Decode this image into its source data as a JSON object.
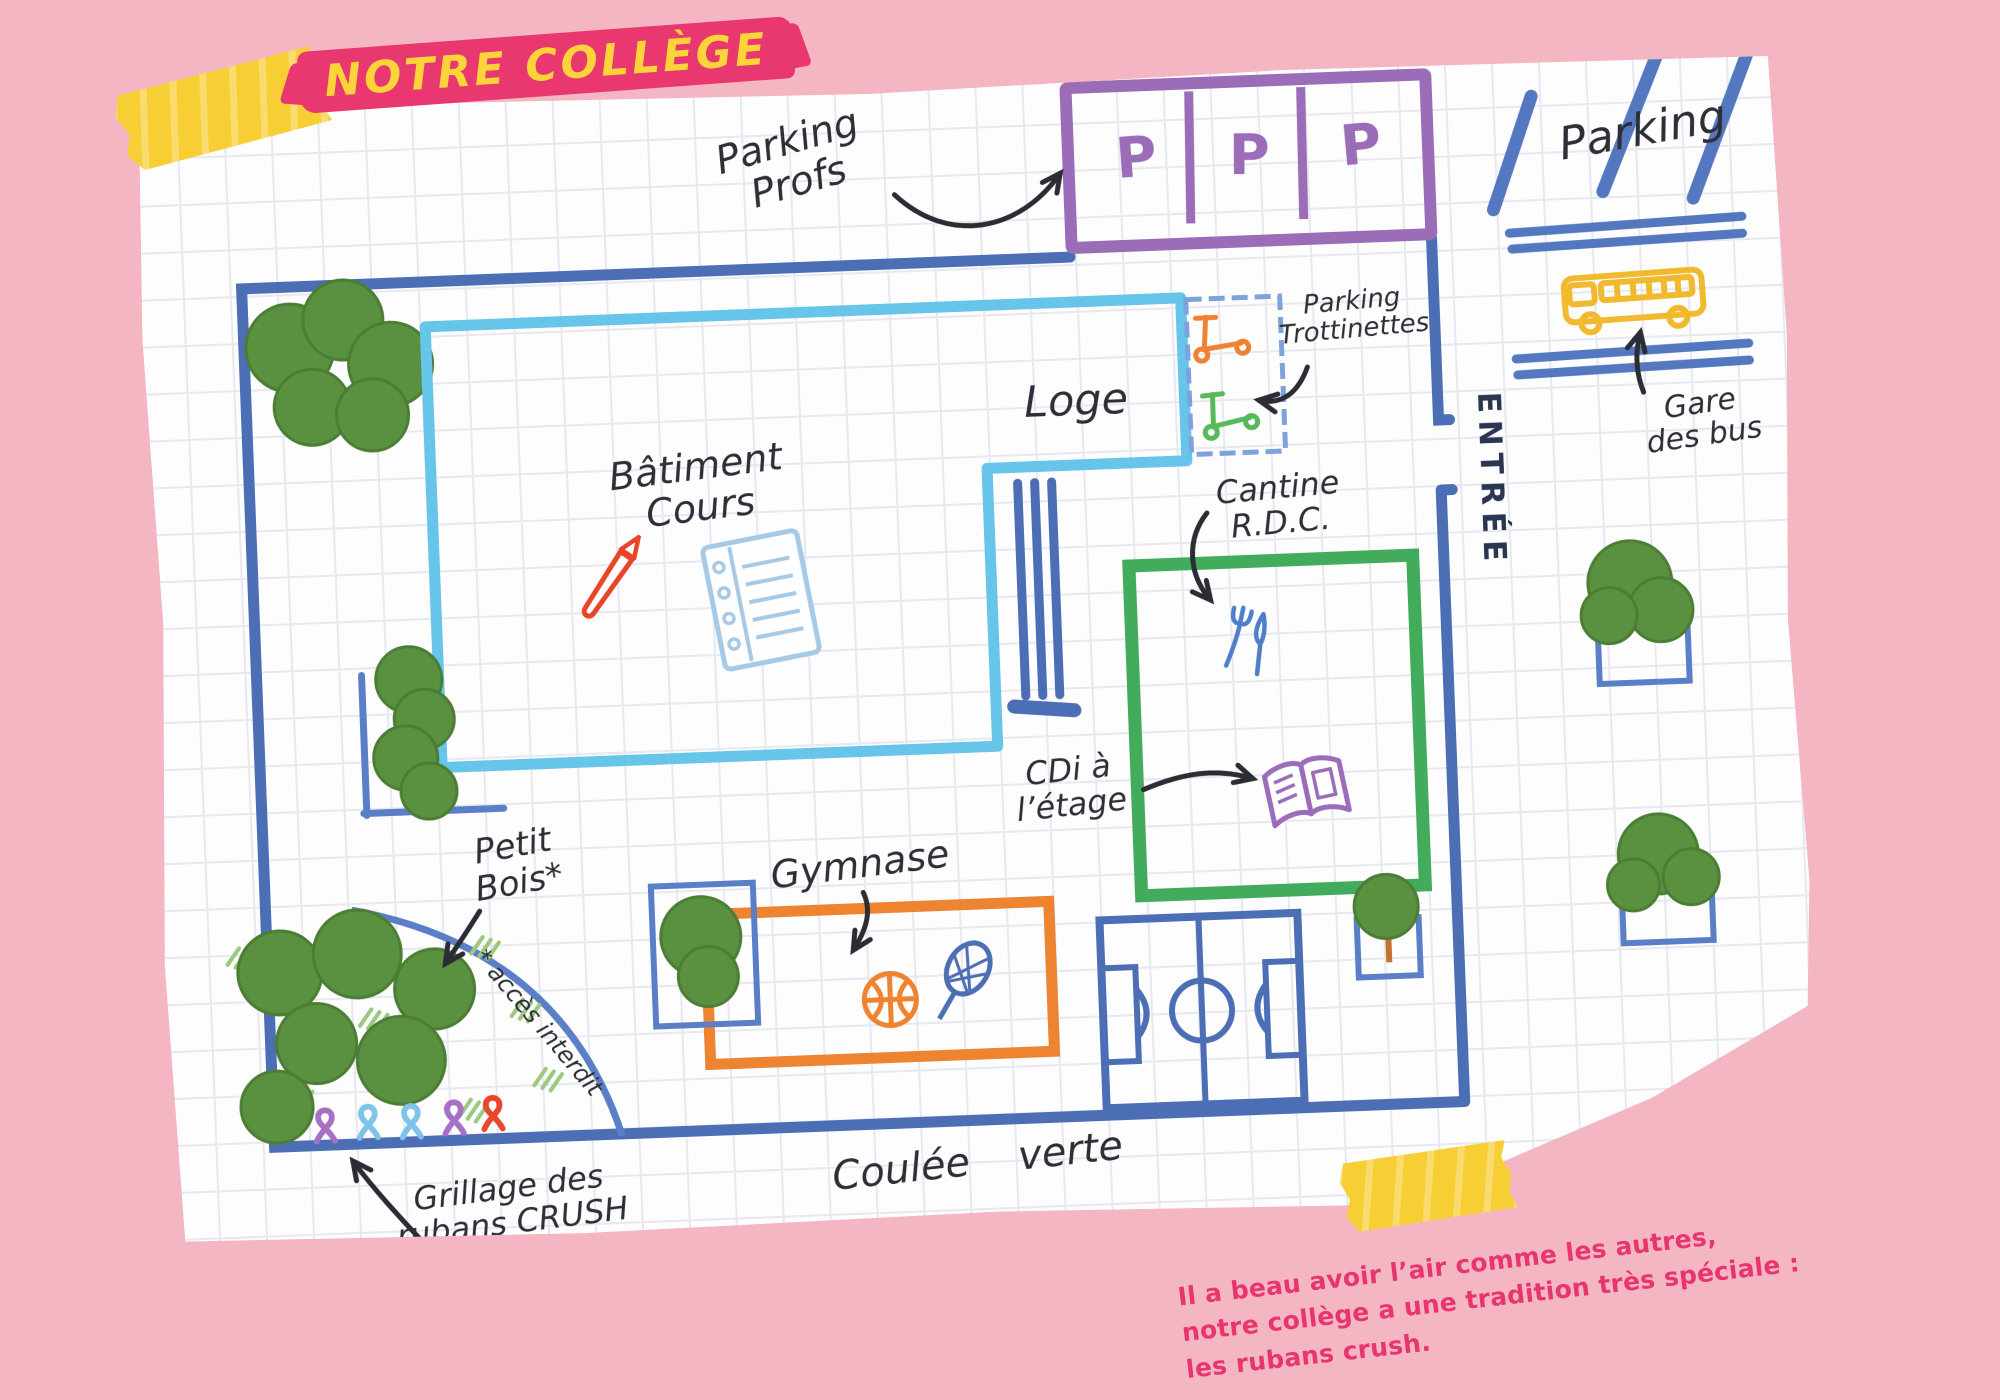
{
  "title_banner": {
    "text": "NOTRE COLLÈGE",
    "bg_color": "#e8386f",
    "text_color": "#fbd43a"
  },
  "map": {
    "wall_color": "#4b6eb5",
    "parking_profs": {
      "label_line1": "Parking",
      "label_line2": "Profs",
      "stalls": [
        "P",
        "P",
        "P"
      ],
      "color": "#9b6cb8"
    },
    "street_parking": {
      "label": "Parking"
    },
    "bus_station": {
      "label_line1": "Gare",
      "label_line2": "des bus",
      "bus_color": "#f1b92d"
    },
    "entrance": {
      "label": "ENTRÉE"
    },
    "loge": {
      "label": "Loge"
    },
    "parking_trottinettes": {
      "label_line1": "Parking",
      "label_line2": "Trottinettes"
    },
    "batiment_cours": {
      "label_line1": "Bâtiment",
      "label_line2": "Cours",
      "color": "#66c5e9"
    },
    "cantine": {
      "label_line1": "Cantine",
      "label_line2": "R.D.C.",
      "color": "#43ab5c"
    },
    "cdi": {
      "label_line1": "CDi à",
      "label_line2": "l’étage"
    },
    "gymnase": {
      "label": "Gymnase",
      "color": "#ee8330"
    },
    "petit_bois": {
      "label_line1": "Petit",
      "label_line2": "Bois*",
      "footnote": "* accès interdit"
    },
    "grillage": {
      "label_line1": "Grillage des",
      "label_line2": "rubans CRUSH",
      "ribbon_colors": [
        "#a770c4",
        "#7ec3e8",
        "#7ec3e8",
        "#a770c4",
        "#e8472b"
      ]
    },
    "coulee_verte": {
      "label": "Coulée verte"
    }
  },
  "caption": {
    "color": "#e8356e",
    "line1": "Il a beau avoir l’air comme les autres,",
    "line2": "notre collège a une tradition très spéciale :",
    "line3": "les rubans crush."
  }
}
